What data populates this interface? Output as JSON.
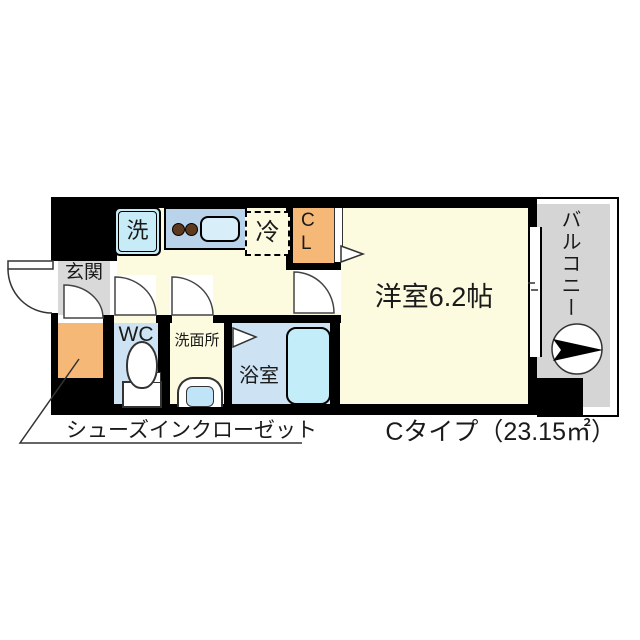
{
  "floor_plan": {
    "unit_type_label": "Cタイプ（23.15㎡）",
    "annotation_shoes_closet": "シューズインクローゼット",
    "rooms": {
      "entrance": {
        "label": "玄関"
      },
      "main_room": {
        "label": "洋室6.2帖"
      },
      "balcony": {
        "label": "バルコニー"
      },
      "toilet": {
        "label": "WC"
      },
      "washroom": {
        "label": "洗面所"
      },
      "bathroom": {
        "label": "浴室"
      }
    },
    "fixtures": {
      "washer": "洗",
      "fridge": "冷",
      "closet_line1": "C",
      "closet_line2": "L"
    },
    "icons": {
      "direction_arrow": "balcony evacuation/direction arrow in circle",
      "door_swings": "quarter-circle door swing symbols",
      "sliding_window": "double-line sliding window symbol"
    },
    "colors": {
      "wall_black": "#000000",
      "floor_cream": "#FCFADF",
      "wet_area_blue": "#CDE3F4",
      "bathtub_cyan": "#C3EDF9",
      "washer_cyan": "#C7ECF7",
      "kitchen_blue": "#B9D3EB",
      "burner_brown": "#5D3A1D",
      "sink_blue": "#D8EEF9",
      "closet_orange": "#F6B877",
      "entrance_gray": "#D9D9D9",
      "balcony_gray": "#D5D5D5"
    }
  }
}
